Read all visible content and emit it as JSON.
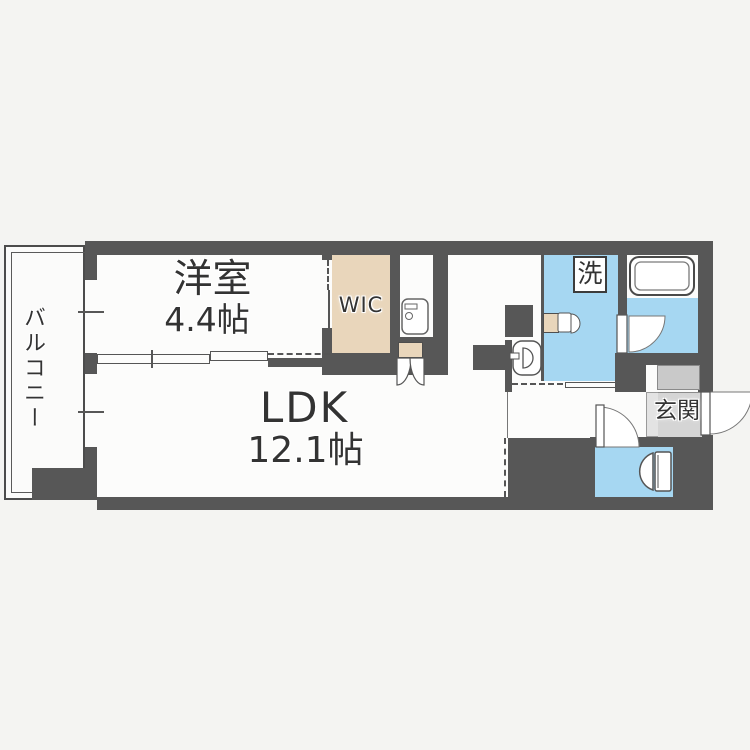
{
  "page": {
    "type": "apartment-floor-plan",
    "background": "#f4f4f2"
  },
  "colors": {
    "wall": "#575757",
    "floor_white": "#fcfcfb",
    "water_blue": "#a6d7f2",
    "closet_beige": "#e9d6bb",
    "entrance_gray": "#d5d5d5",
    "entrance_step_gray": "#e3e3e3",
    "cabinet_gray": "#c9c9c9",
    "text": "#333333"
  },
  "rooms": {
    "balcony": {
      "label": "バルコニー"
    },
    "bedroom": {
      "label": "洋室",
      "size": "4.4帖"
    },
    "wic": {
      "label": "WIC"
    },
    "ldk": {
      "label": "LDK",
      "size": "12.1帖"
    },
    "washroom": {
      "laundry_label": "洗"
    },
    "entrance": {
      "label": "玄関"
    }
  },
  "fixtures": [
    "bathtub",
    "toilet",
    "washbasin",
    "vanity-sink",
    "kitchen-sink",
    "entrance-door",
    "bathroom-door",
    "toilet-door",
    "double-closet-door",
    "sliding-partition",
    "windows"
  ]
}
